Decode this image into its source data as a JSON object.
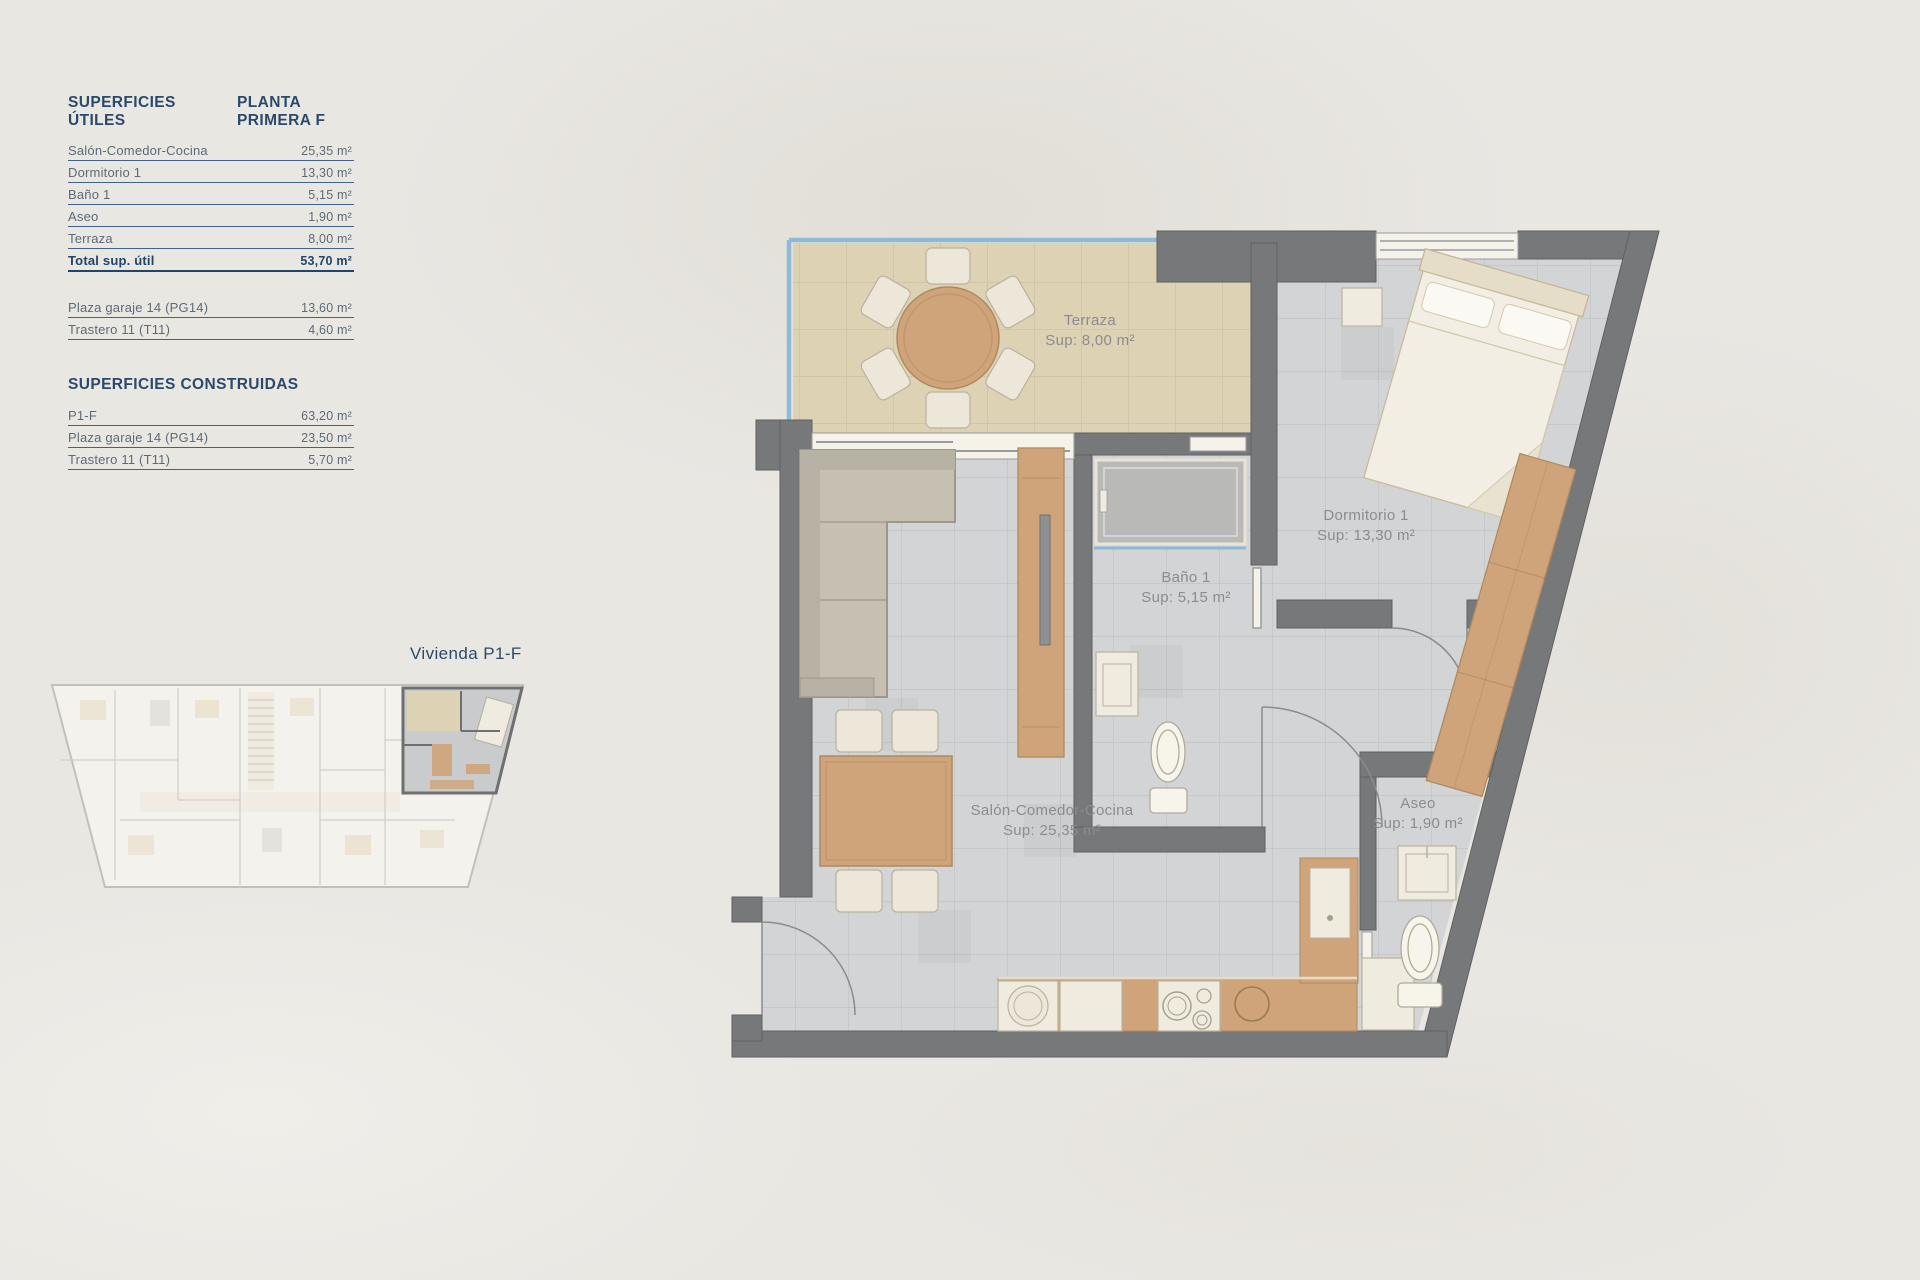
{
  "useful": {
    "title": "SUPERFICIES ÚTILES",
    "plan_title": "PLANTA PRIMERA F",
    "rows": [
      {
        "label": "Salón-Comedor-Cocina",
        "value": "25,35 m²"
      },
      {
        "label": "Dormitorio 1",
        "value": "13,30 m²"
      },
      {
        "label": "Baño 1",
        "value": "5,15 m²"
      },
      {
        "label": "Aseo",
        "value": "1,90 m²"
      },
      {
        "label": "Terraza",
        "value": "8,00 m²"
      }
    ],
    "total": {
      "label": "Total sup. útil",
      "value": "53,70 m²"
    },
    "extras": [
      {
        "label": "Plaza garaje 14 (PG14)",
        "value": "13,60 m²"
      },
      {
        "label": "Trastero 11 (T11)",
        "value": "4,60 m²"
      }
    ]
  },
  "built": {
    "title": "SUPERFICIES CONSTRUIDAS",
    "rows": [
      {
        "label": "P1-F",
        "value": "63,20 m²"
      },
      {
        "label": "Plaza garaje 14 (PG14)",
        "value": "23,50 m²"
      },
      {
        "label": "Trastero 11 (T11)",
        "value": "5,70 m²"
      }
    ]
  },
  "key_plan": {
    "unit_label": "Vivienda P1-F"
  },
  "plan": {
    "rooms": {
      "terraza": {
        "name": "Terraza",
        "sup": "Sup: 8,00 m²"
      },
      "dormitorio": {
        "name": "Dormitorio 1",
        "sup": "Sup: 13,30 m²"
      },
      "bano": {
        "name": "Baño 1",
        "sup": "Sup: 5,15 m²"
      },
      "salon": {
        "name": "Salón-Comedor-Cocina",
        "sup": "Sup: 25,35 m²"
      },
      "aseo": {
        "name": "Aseo",
        "sup": "Sup: 1,90 m²"
      }
    }
  },
  "colors": {
    "accent_navy": "#2b4a6b",
    "table_text": "#5d6a78",
    "wall_gray": "#77787a",
    "floor_gray": "#d2d4d6",
    "terrace_beige": "#ddd2b4",
    "wood": "#cfa47a",
    "glass_blue": "#8ab8d6",
    "label_gray": "#8b8c8e",
    "background": "#e9e7e2"
  }
}
